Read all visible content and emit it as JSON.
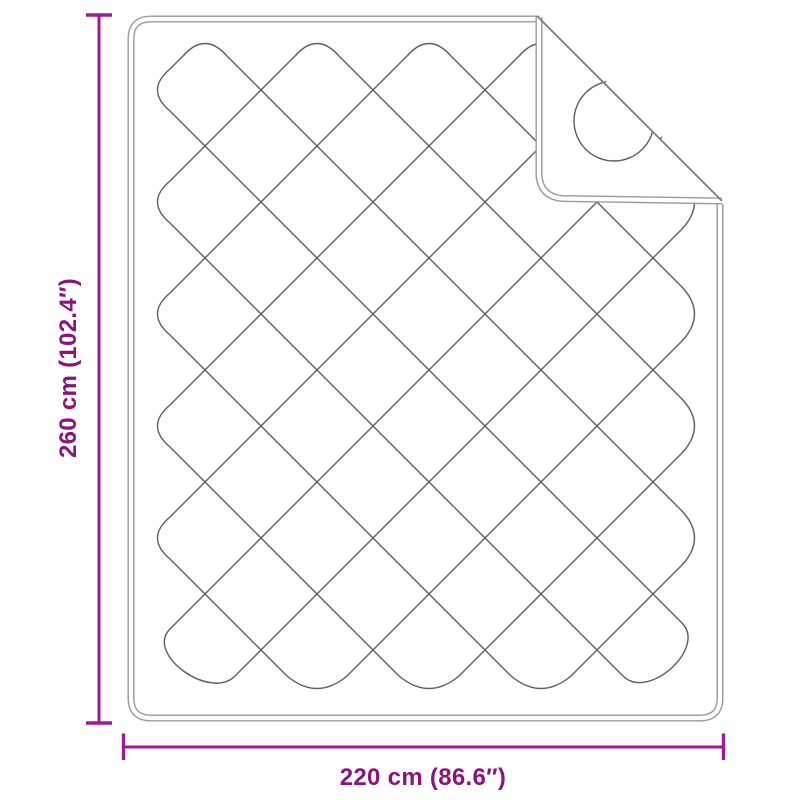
{
  "diagram": {
    "vertical_dimension": {
      "label": "260 cm (102.4″)",
      "value_cm": 260,
      "value_in": 102.4
    },
    "horizontal_dimension": {
      "label": "220 cm (86.6″)",
      "value_cm": 220,
      "value_in": 86.6
    },
    "colors": {
      "dimension_line": "#9B1C93",
      "dimension_text": "#8B1480",
      "blanket_outline": "#9a9a9a",
      "quilt_line": "#5d5d5d",
      "fold_line": "#7a7a7a"
    }
  }
}
